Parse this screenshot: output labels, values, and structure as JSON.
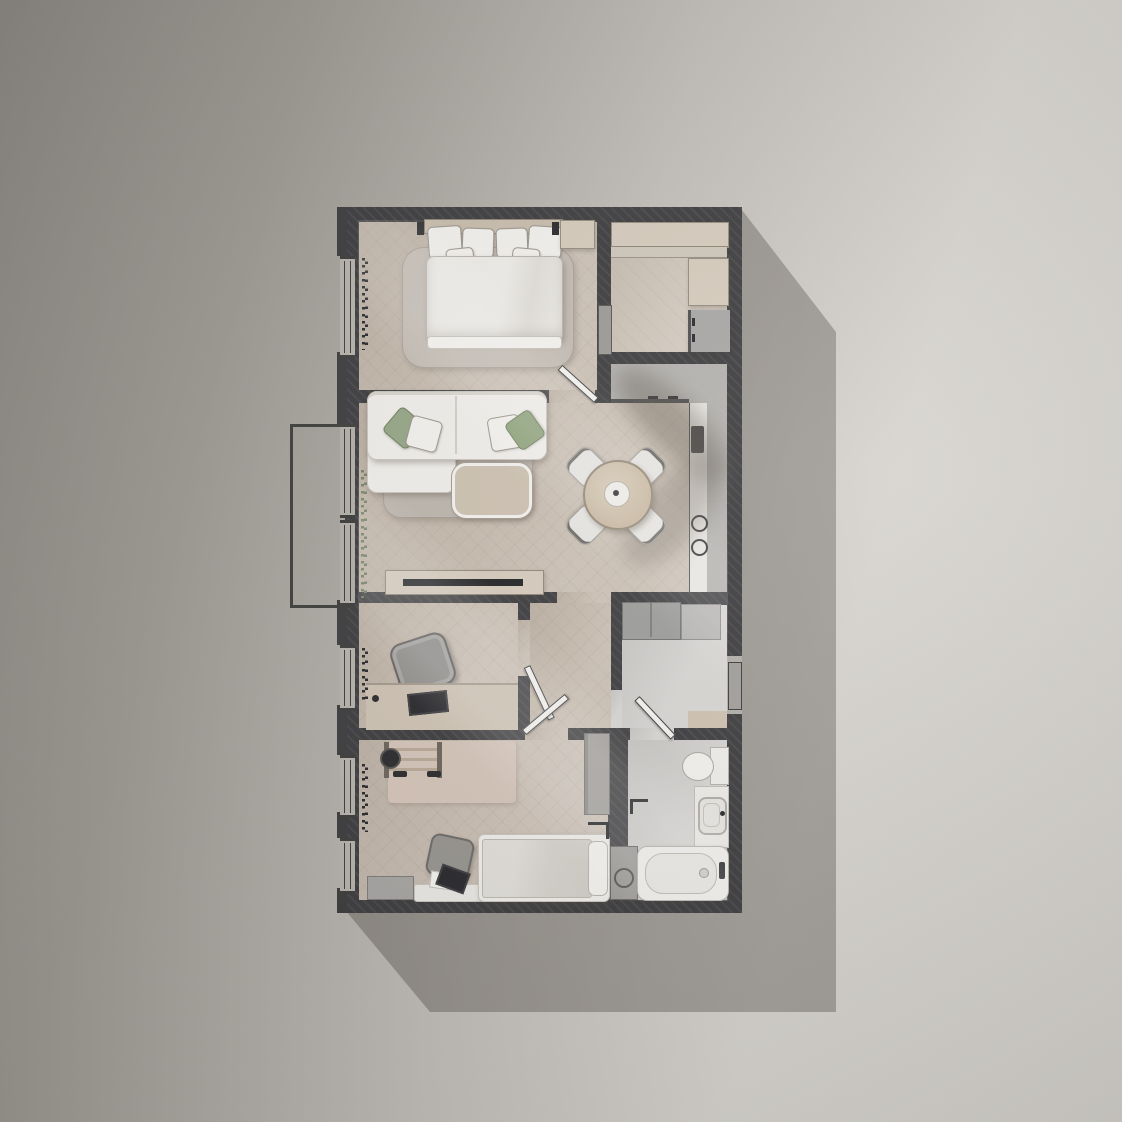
{
  "scene": {
    "type": "apartment floor plan, top-down 3D render",
    "wall_color": "#3a3a3c",
    "background_gradient": [
      "#8a8680",
      "#d6d3ce"
    ],
    "cast_shadow_color": "rgba(62,58,53,0.35)",
    "floor_wood": "#c7bbae",
    "floor_tile": "#d0cecb",
    "accent_green": "#95a584"
  },
  "rooms": [
    {
      "name": "bedroom",
      "furniture": [
        "double-bed",
        "pillows",
        "area-rug",
        "nightstand",
        "wall-lamps",
        "curtains",
        "window"
      ]
    },
    {
      "name": "walk-in-closet",
      "furniture": [
        "wardrobe-top",
        "wardrobe-shelf",
        "wardrobe-side",
        "fridge-cabinet",
        "sliding-door"
      ]
    },
    {
      "name": "living-dining-room",
      "furniture": [
        "corner-sofa",
        "green-pillows",
        "area-rug",
        "coffee-table",
        "round-dining-table",
        "four-chairs",
        "tv-console",
        "tv",
        "plants"
      ]
    },
    {
      "name": "kitchen",
      "furniture": [
        "counter-band",
        "counter-column",
        "base-cabinets",
        "sink-block",
        "cooktop-burners",
        "handles"
      ]
    },
    {
      "name": "study",
      "furniture": [
        "desk",
        "laptop",
        "office-chair",
        "curtains",
        "window"
      ]
    },
    {
      "name": "hallway",
      "furniture": [
        "doors"
      ]
    },
    {
      "name": "entry-utility",
      "furniture": [
        "cabinet-dark",
        "cabinet-light",
        "door-mat",
        "entry-door"
      ]
    },
    {
      "name": "kids-bedroom",
      "furniture": [
        "single-bed",
        "pillow",
        "wall-bars",
        "rug",
        "dumbbells",
        "desk",
        "desk-chair",
        "laptop",
        "wardrobe",
        "curtains"
      ]
    },
    {
      "name": "bathroom",
      "furniture": [
        "bathtub",
        "washing-machine",
        "vanity-sink",
        "toilet",
        "towel-rail",
        "faucet"
      ]
    },
    {
      "name": "balcony",
      "furniture": [
        "railing-outline"
      ]
    }
  ],
  "counts": {
    "interior_doors": 4,
    "windows": 6,
    "dining_chairs": 4
  }
}
